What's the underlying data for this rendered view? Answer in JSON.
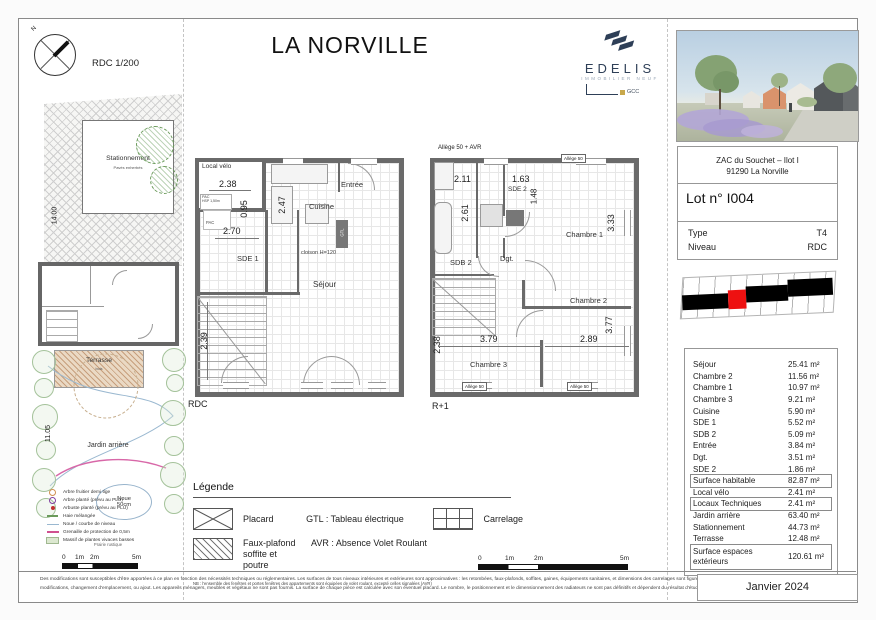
{
  "sheet": {
    "title": "LA NORVILLE",
    "scale_label": "RDC 1/200",
    "north": "N"
  },
  "brand": {
    "name": "EDELIS",
    "tagline": "IMMOBILIER NEUF",
    "group": "GCC"
  },
  "colors": {
    "brand_navy": "#2e3f57",
    "lot_highlight": "#ee1111",
    "wall_gray": "#6a6a6a"
  },
  "panel": {
    "address1": "ZAC du Souchet – Ilot I",
    "address2": "91290 La Norville",
    "lot": "Lot n° I004",
    "type_label": "Type",
    "type_value": "T4",
    "level_label": "Niveau",
    "level_value": "RDC"
  },
  "areas": {
    "rows": [
      {
        "label": "Séjour",
        "value": "25.41 m²"
      },
      {
        "label": "Chambre 2",
        "value": "11.56 m²"
      },
      {
        "label": "Chambre 1",
        "value": "10.97 m²"
      },
      {
        "label": "Chambre 3",
        "value": "9.21 m²"
      },
      {
        "label": "Cuisine",
        "value": "5.90 m²"
      },
      {
        "label": "SDE 1",
        "value": "5.52 m²"
      },
      {
        "label": "SDB 2",
        "value": "5.09 m²"
      },
      {
        "label": "Entrée",
        "value": "3.84 m²"
      },
      {
        "label": "Dgt.",
        "value": "3.51 m²"
      },
      {
        "label": "SDE 2",
        "value": "1.86 m²"
      },
      {
        "label": "Surface habitable",
        "value": "82.87 m²"
      },
      {
        "label": "Local vélo",
        "value": "2.41 m²"
      },
      {
        "label": "Locaux Techniques",
        "value": "2.41 m²"
      },
      {
        "label": "Jardin arrière",
        "value": "63.40 m²"
      },
      {
        "label": "Stationnement",
        "value": "44.73 m²"
      },
      {
        "label": "Terrasse",
        "value": "12.48 m²"
      },
      {
        "label": "Surface espaces extérieurs",
        "value": "120.61 m²"
      }
    ]
  },
  "plans": {
    "rdc": {
      "caption": "RDC",
      "local_velo": "Local vélo",
      "dim_238": "2.38",
      "pac1": "PAC",
      "hsp": "HSP 1,50m",
      "pac2": "PAC",
      "entree": "Entrée",
      "cuisine": "Cuisine",
      "dim_095": "0.95",
      "dim_247": "2.47",
      "dim_270": "2.70",
      "sde1": "SDE 1",
      "gtl": "GTL",
      "cloison": "cloison H=120",
      "sejour": "Séjour",
      "dim_239": "2.39"
    },
    "r1": {
      "caption": "R+1",
      "allege_avr": "Allège 50 + AVR",
      "allege_top": "Allège 50",
      "dim_211": "2.11",
      "dim_163": "1.63",
      "sde2": "SDE 2",
      "dim_148": "1.48",
      "dim_261": "2.61",
      "sdb2": "SDB 2",
      "chambre1": "Chambre 1",
      "dim_333": "3.33",
      "dgt": "Dgt.",
      "chambre2": "Chambre 2",
      "dim_377": "3.77",
      "dim_379": "3.79",
      "dim_289": "2.89",
      "dim_238": "2.38",
      "chambre3": "Chambre 3",
      "allege_b1": "Allège 50",
      "allege_b2": "Allège 50"
    }
  },
  "site": {
    "stationnement": "Stationnement",
    "stationnement_sub": "Pavés enherbés",
    "terrasse": "Terrasse",
    "terrasse_sub": "bois",
    "jardin": "Jardin arrière",
    "noue1": "Noue",
    "noue2": "50cm",
    "caption": "Prairie rustique",
    "dim_top": "14.00",
    "dim_bottom": "11.05",
    "legend": [
      {
        "symbol": "orange-ring",
        "label": "Arbre fruitier demi tige"
      },
      {
        "symbol": "purple-ring",
        "label": "Arbre planté (prévu au PLU)"
      },
      {
        "symbol": "red-dot",
        "label": "Arbuste planté (prévu au PLU)"
      },
      {
        "symbol": "green-dash",
        "label": "Haie mélangée"
      },
      {
        "symbol": "blue-line",
        "label": "Noue / courbe de niveau"
      },
      {
        "symbol": "pink-line",
        "label": "Grenaille de protection de 0,5m"
      },
      {
        "symbol": "green-fill",
        "label": "Massif de plantes vivaces basses"
      }
    ]
  },
  "legend": {
    "title": "Légende",
    "placard": "Placard",
    "gtl": "GTL : Tableau électrique",
    "carrelage": "Carrelage",
    "faux_plafond1": "Faux-plafond",
    "faux_plafond2": "soffite et poutre",
    "avr": "AVR : Absence Volet Roulant",
    "note": "NB : l'ensemble des fenêtres et portes fenêtres des appartements sont équipées de volet roulant, excepté celles signalées (AVR)"
  },
  "scalebar": {
    "zero": "0",
    "one": "1m",
    "two": "2m",
    "five": "5m"
  },
  "footer": {
    "line1": "Des modifications sont susceptibles d'être apportées à ce plan en fonction des nécessités techniques ou réglementaires. Les surfaces de tous niveaux intérieures et extérieures sont approximatives : les retombées, faux-plafonds, soffites, gaines, équipements sanitaires, et dimensions des carrelages sont figurés à titre indicatif, et peuvent subir des",
    "line2": "modifications, changement d'emplacement, ou ajout. Les appareils ménagers, meubles et végétaux ne sont pas fournis. La surface de chaque pièce est calculée avec son éventuel placard. Le nombre, le positionnement et le dimensionnement des radiateurs ne sont pas définitifs et dépendent du résultat d'étude thermique",
    "date": "Janvier 2024"
  }
}
